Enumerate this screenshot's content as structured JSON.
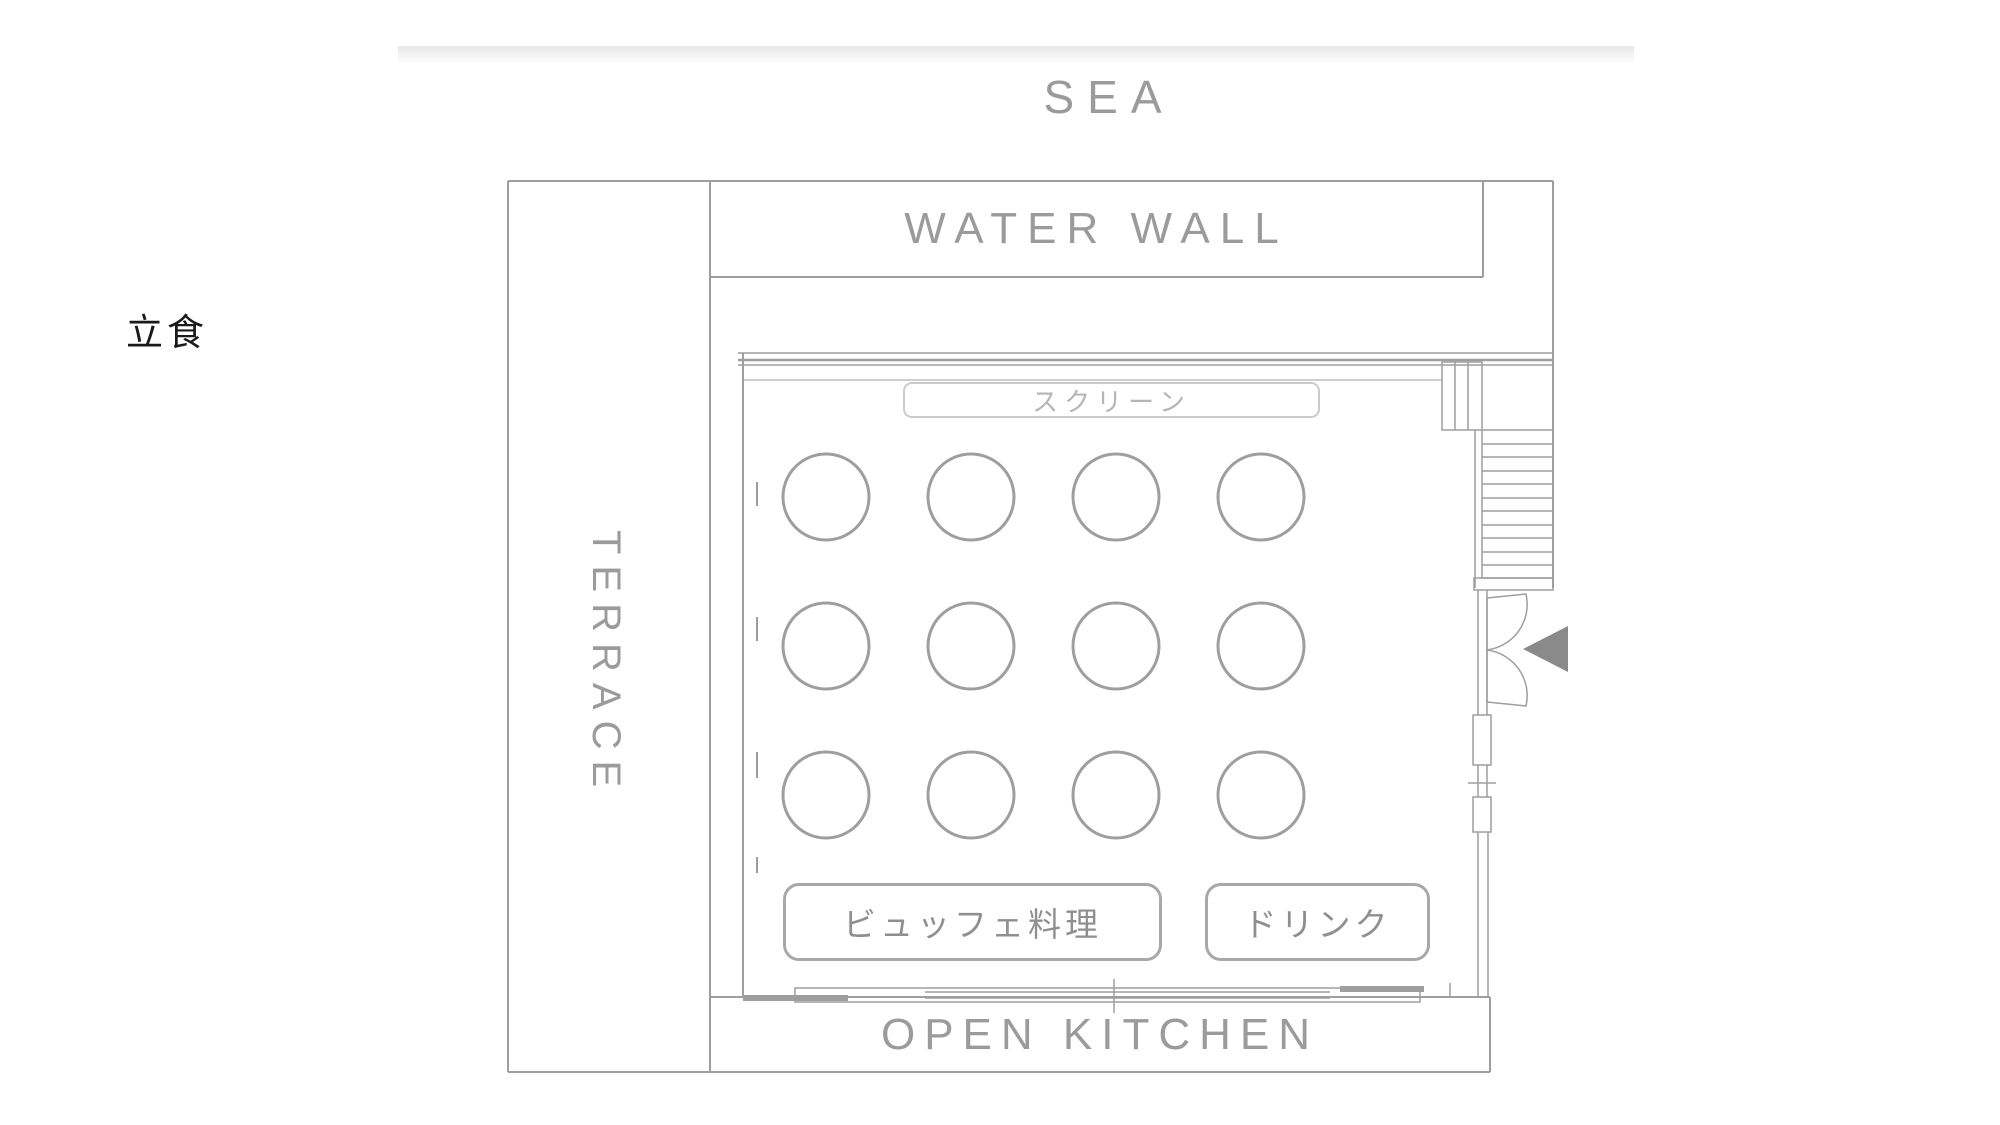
{
  "page": {
    "area_label": "SEA",
    "event_type_label": "立食"
  },
  "plan": {
    "water_wall_label": "WATER WALL",
    "terrace_label": "TERRACE",
    "open_kitchen_label": "OPEN KITCHEN",
    "screen_label": "スクリーン",
    "buffet_label": "ビュッフェ料理",
    "drink_label": "ドリンク",
    "tables": {
      "count": 12,
      "rows": 3,
      "cols": 4,
      "shape": "round",
      "radius": 43,
      "origin_x": 826,
      "origin_y": 497,
      "dx": 145,
      "dy": 149
    },
    "colors": {
      "wall_line": "#9e9e9e",
      "label_text": "#9b9b9b",
      "screen_text": "#b5b5b5",
      "food_text": "#8f8f8f",
      "event_text": "#1a1a1a",
      "entrance_arrow": "#8a8a8a",
      "header_shadow": "#e8e8e8"
    }
  }
}
